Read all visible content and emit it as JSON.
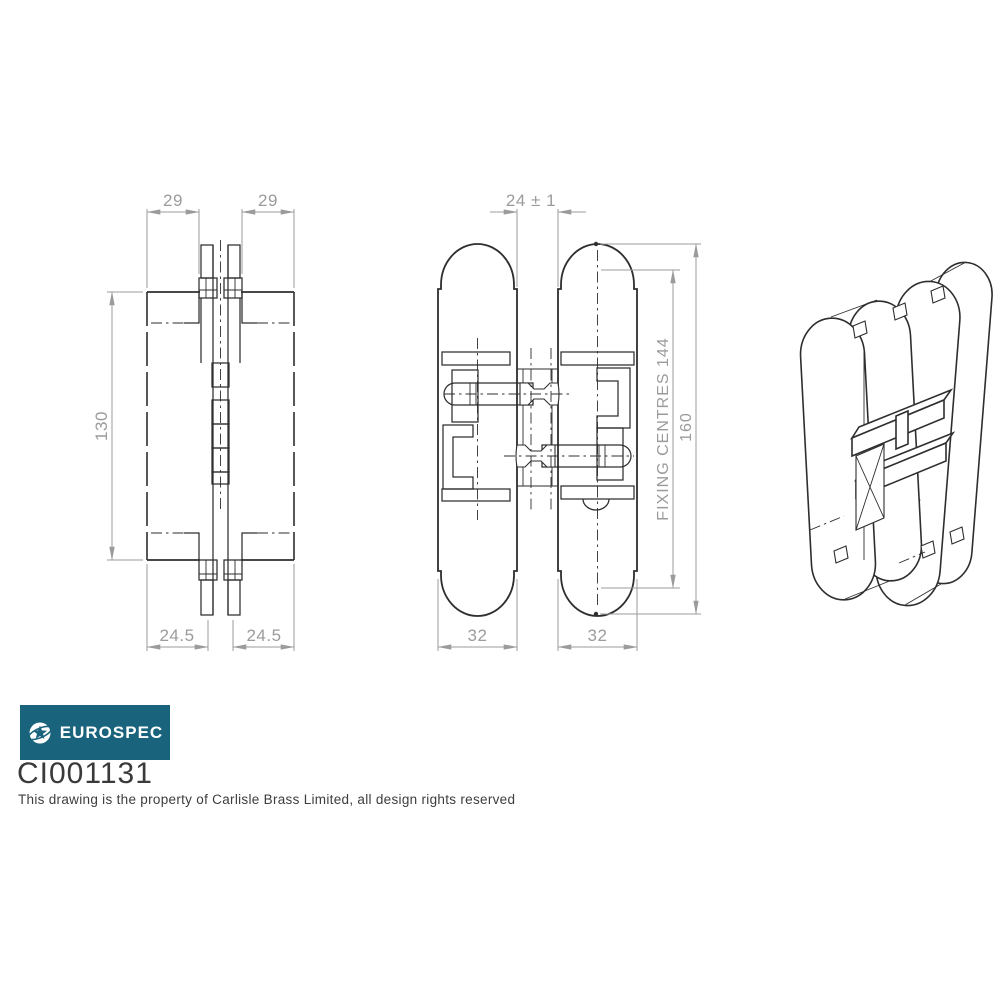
{
  "drawing": {
    "side_view": {
      "dim_top_left": "29",
      "dim_top_right": "29",
      "dim_height": "130",
      "dim_bottom_left": "24.5",
      "dim_bottom_right": "24.5"
    },
    "front_view": {
      "dim_gap": "24 ± 1",
      "dim_fixing_centres": "FIXING CENTRES 144",
      "dim_overall_height": "160",
      "dim_width_left": "32",
      "dim_width_right": "32"
    }
  },
  "title_block": {
    "brand": "EUROSPEC",
    "logo_icon": "globe-star-icon",
    "logo_bg_color": "#19637C",
    "product_code": "CI001131",
    "disclaimer": "This drawing is the property of Carlisle Brass Limited, all design rights reserved"
  },
  "colors": {
    "drawing_line": "#2e2e2e",
    "dimension": "#9b9b9b",
    "background": "#ffffff"
  }
}
